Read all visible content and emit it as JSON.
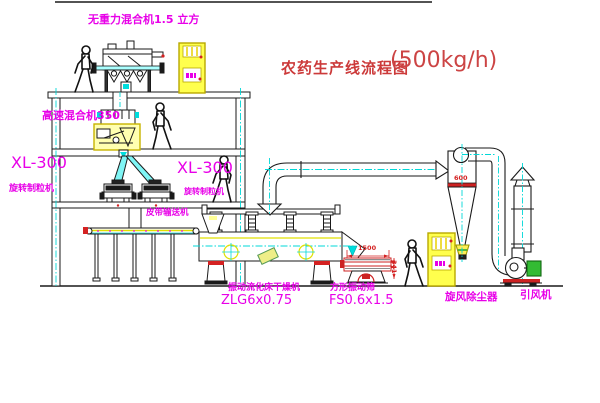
{
  "title": {
    "name": "农药生产线流程图",
    "capacity": "(500kg/h)"
  },
  "equipment": {
    "gravity_mixer": {
      "label": "无重力混合机1.5 立方"
    },
    "high_speed_mixer": {
      "label": "高速混合机350"
    },
    "granulator_left": {
      "model": "XL-300",
      "name": "旋转制粒机"
    },
    "granulator_right": {
      "model": "XL-300",
      "name": "旋转制粒机"
    },
    "belt_conveyor": {
      "label": "皮带输送机"
    },
    "fluid_bed_dryer": {
      "name": "振动流化床干燥机",
      "model": "ZLG6x0.75"
    },
    "vibrating_screen": {
      "name": "方形振动筛",
      "model": "FS0.6x1.5"
    },
    "cyclone": {
      "label": "旋风除尘器",
      "diameter": "600"
    },
    "fan": {
      "label": "引风机"
    }
  },
  "dimensions": {
    "screen_length": "1500",
    "screen_height": "341"
  },
  "colors": {
    "label_magenta": "#e800e8",
    "title_red": "#cc3a3a",
    "dimension_red": "#d42222",
    "centerline_cyan": "#00d8d8",
    "equipment_yellow": "#ffff4d",
    "line_black": "#1a1a1a"
  }
}
